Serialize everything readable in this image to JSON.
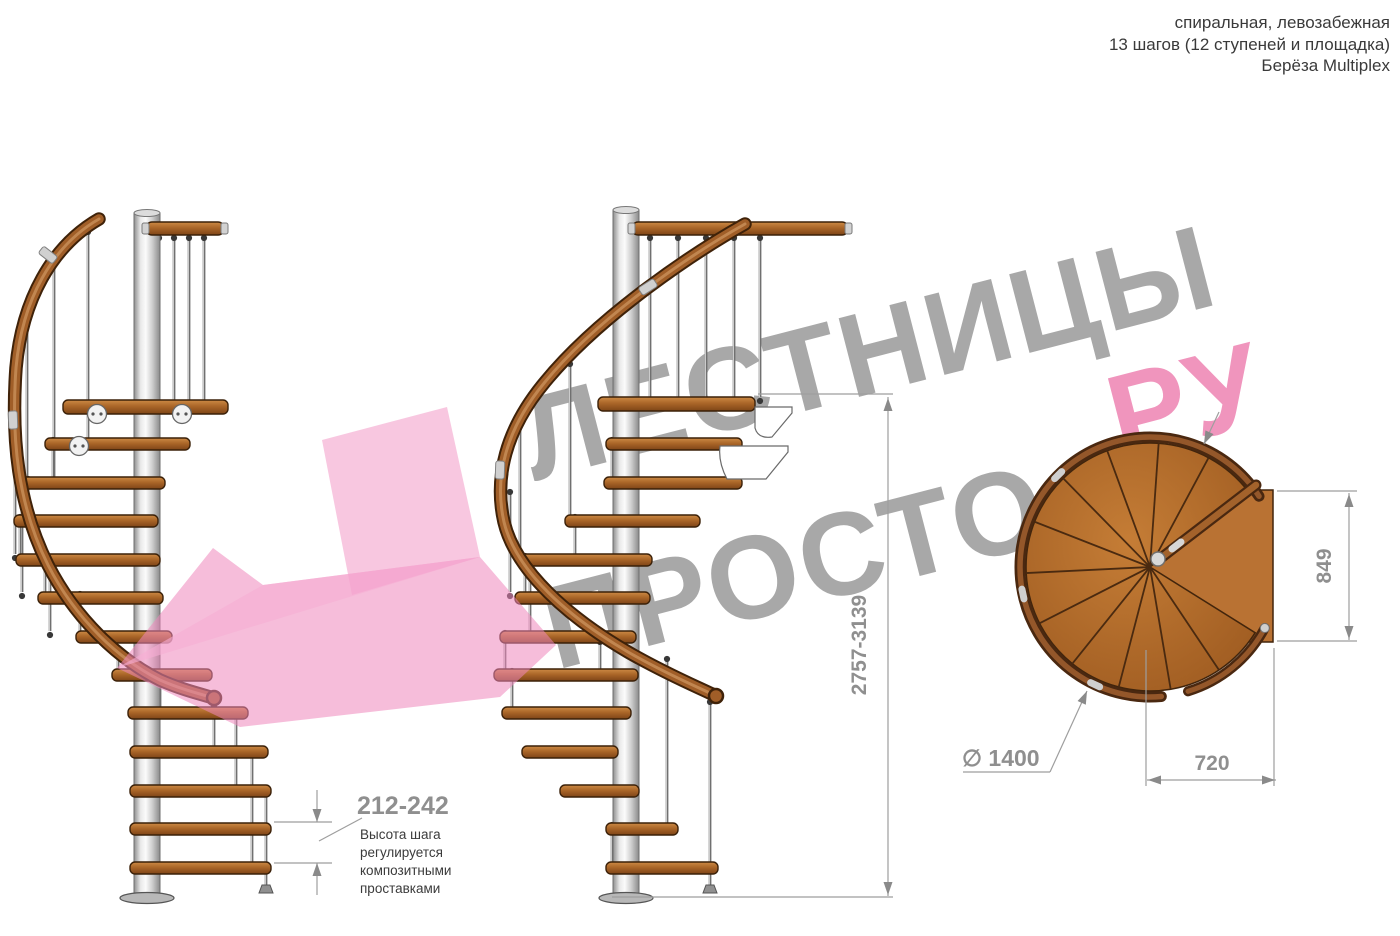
{
  "header": {
    "line1": "спиральная, левозабежная",
    "line2": "13 шагов (12 ступеней и площадка)",
    "line3": "Берёза Multiplex"
  },
  "watermark": {
    "line1": "ЛЕСТНИЦЫ",
    "line2": "ПРОСТО",
    "suffix": ".РУ"
  },
  "dimensions": {
    "total_height": "2757-3139",
    "landing_depth": "849",
    "exit_width": "720",
    "diameter": "∅ 1400",
    "step_height": "212-242",
    "note_lines": [
      "Высота шага",
      "регулируется",
      "композитными",
      "проставками"
    ]
  },
  "colors": {
    "wood_light": "#cd8a45",
    "wood_mid": "#aa6628",
    "wood_dark": "#7e4517",
    "wood_edge": "#3b2109",
    "rail_outer": "#3f2209",
    "rail_inner": "#a05e28",
    "rail_core": "#c9905a",
    "metal_light": "#fbfbfb",
    "metal_dark": "#8a8a8a",
    "watermark_gray": "#a8a8a8",
    "watermark_pink": "#f095bd",
    "arrow_pink_tail": "#f190c2",
    "arrow_pink_body": "#ee86bc",
    "arrow_pink_light": "#f6aed4",
    "dim_line": "#9e9e9e",
    "dim_arrow": "#8a8a8a",
    "dim_text": "#8f8f8f",
    "note_text": "#3b3b3b",
    "header_text": "#3a3a3a"
  }
}
